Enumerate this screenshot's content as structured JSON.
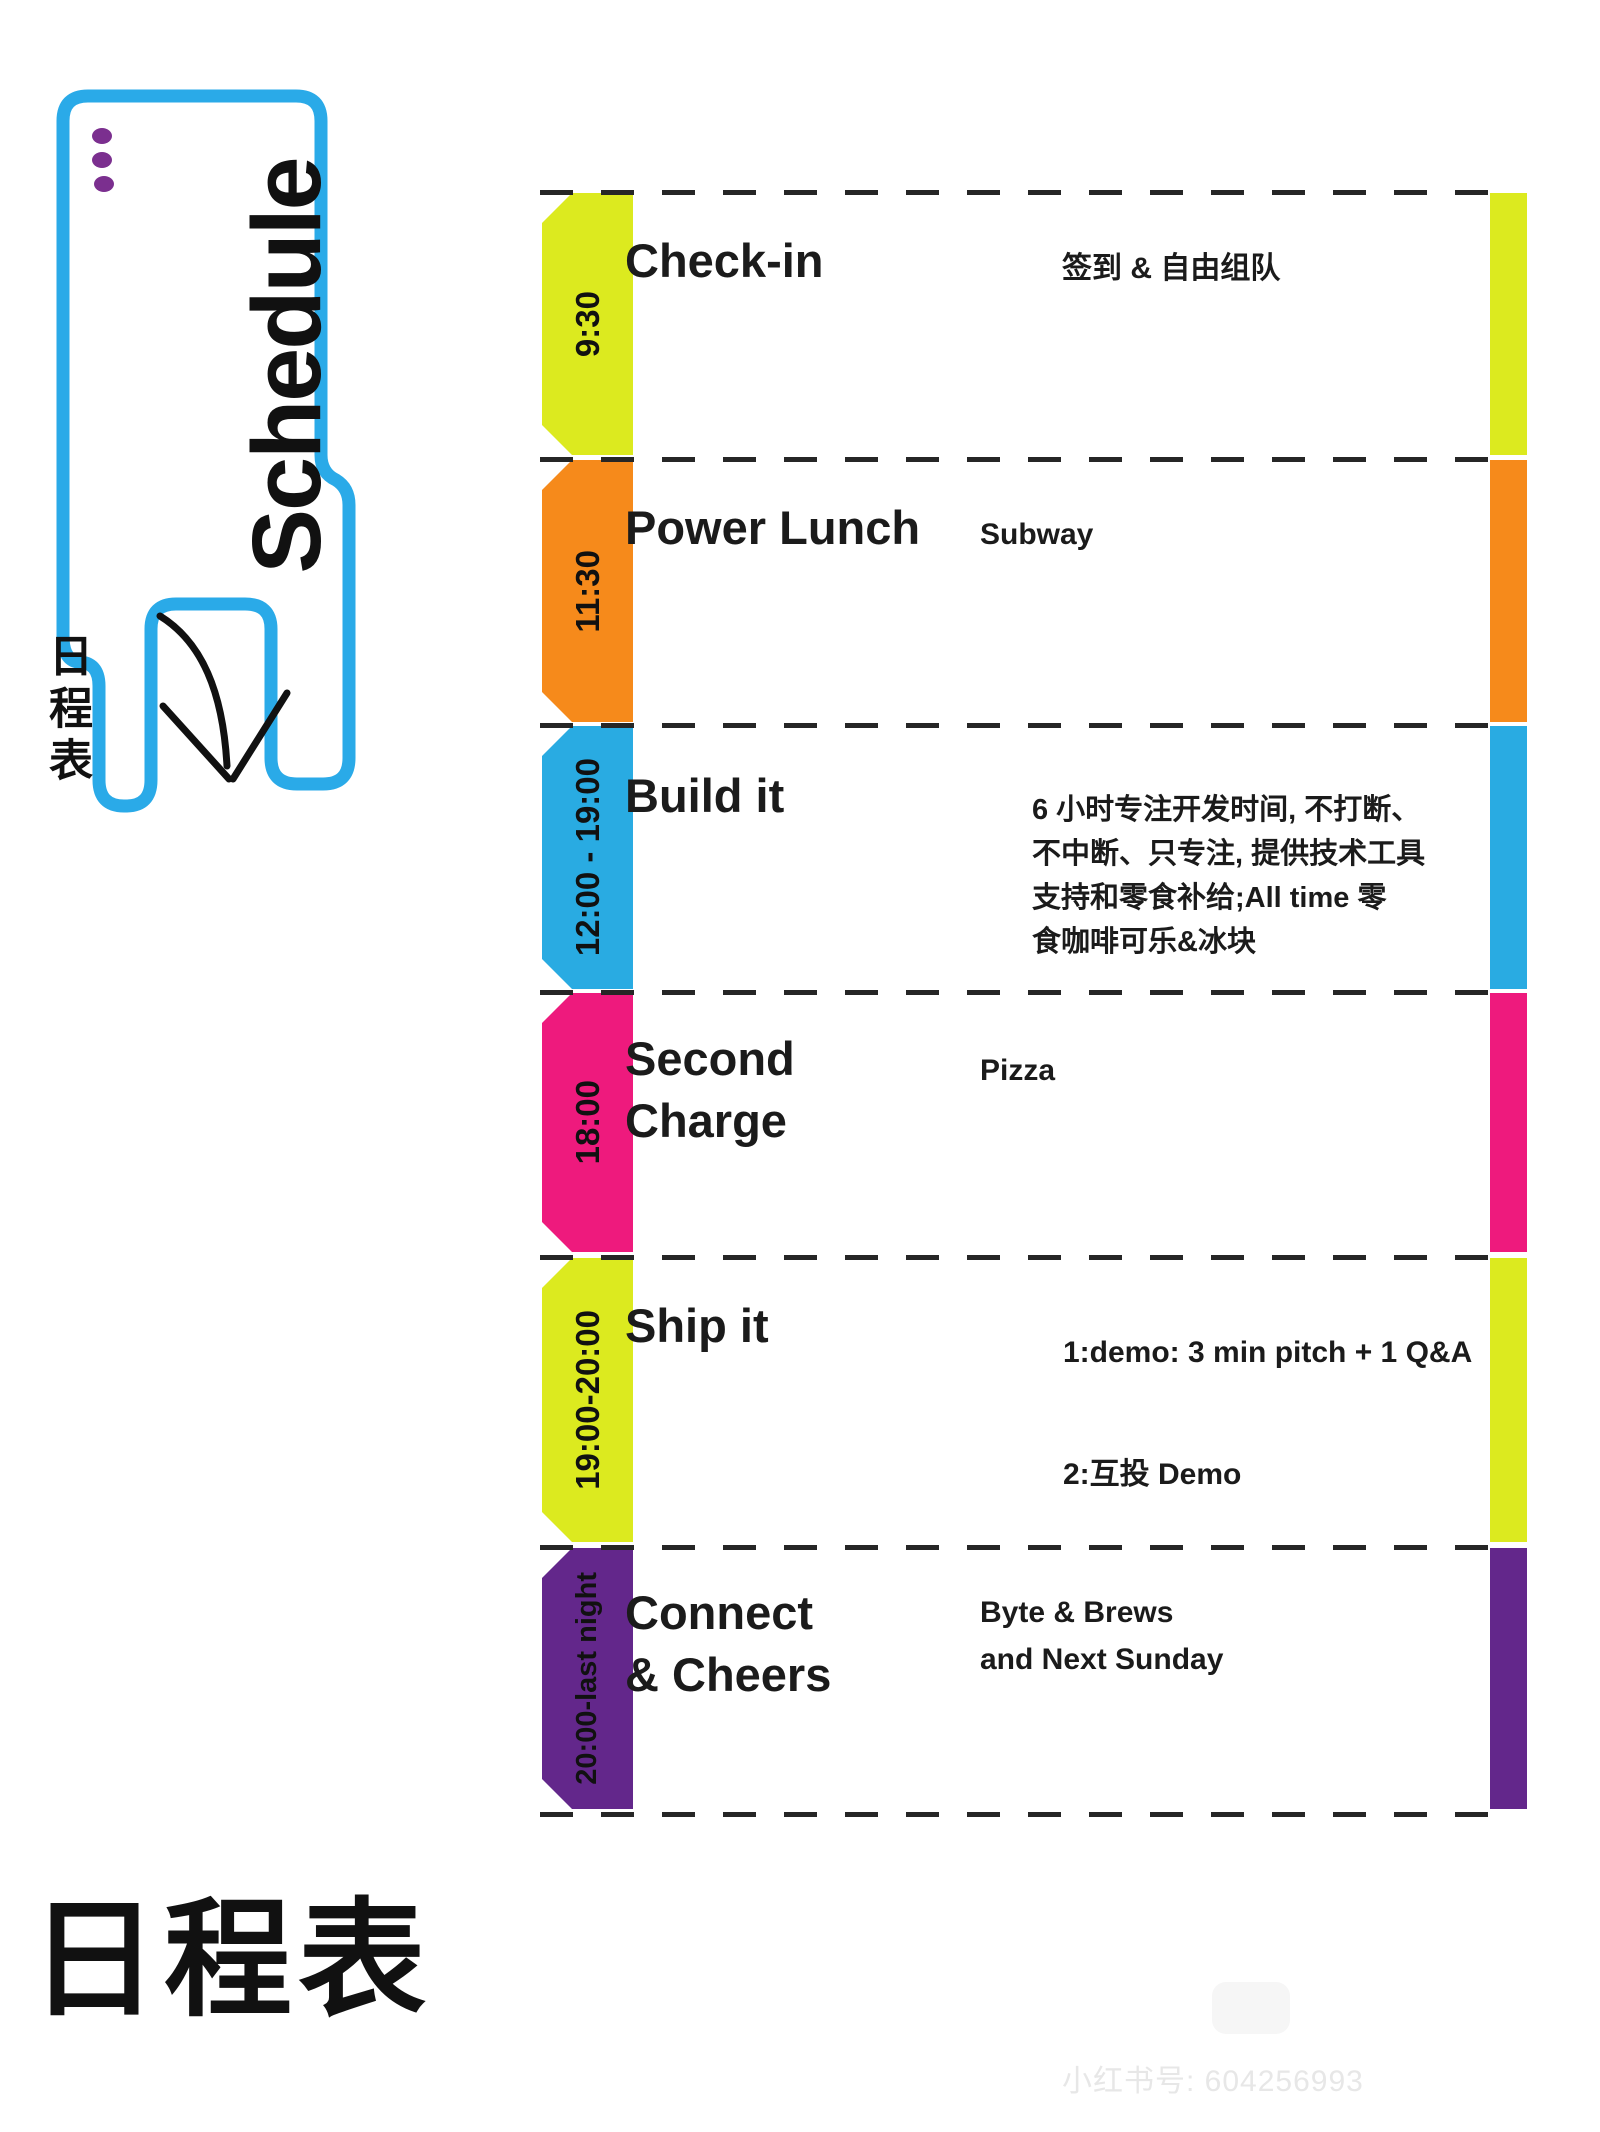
{
  "header": {
    "schedule_vertical": "Schedule",
    "richengbiao_vertical": "日程表"
  },
  "colors": {
    "outline_blue": "#2aaae8",
    "dot_purple": "#7b2f8f",
    "dash": "#262626",
    "yellow": "#dcea1f",
    "orange": "#f68a1b",
    "blue": "#29abe2",
    "magenta": "#ee1a7d",
    "purple": "#63278b"
  },
  "schedule": {
    "rows": [
      {
        "time": "9:30",
        "title": "Check-in",
        "desc": "签到 & 自由组队",
        "color": "#dcea1f"
      },
      {
        "time": "11:30",
        "title": "Power Lunch",
        "desc": "Subway",
        "color": "#f68a1b"
      },
      {
        "time": "12:00 - 19:00",
        "title": "Build it",
        "desc": "6 小时专注开发时间, 不打断、\n不中断、只专注, 提供技术工具\n支持和零食补给;All time 零\n食咖啡可乐&冰块",
        "color": "#29abe2"
      },
      {
        "time": "18:00",
        "title": "Second\nCharge",
        "desc": "Pizza",
        "color": "#ee1a7d"
      },
      {
        "time": "19:00-20:00",
        "title": "Ship it",
        "desc": "1:demo: 3 min pitch + 1 Q&A",
        "desc2": "2:互投 Demo",
        "color": "#dcea1f"
      },
      {
        "time": "20:00-last night",
        "title": "Connect\n& Cheers",
        "desc": "Byte & Brews\nand Next Sunday",
        "color": "#63278b"
      }
    ]
  },
  "footer": {
    "title_cn": "日程表",
    "watermark": "小红书号: 604256993"
  }
}
